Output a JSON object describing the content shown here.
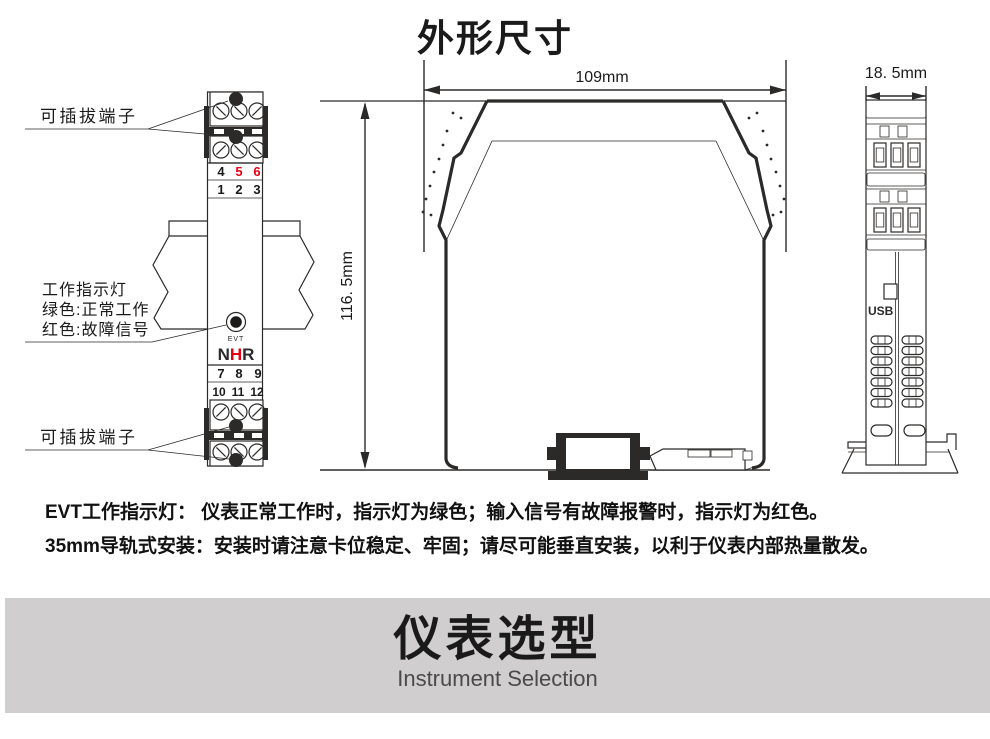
{
  "title": "外形尺寸",
  "front_view": {
    "label_pluggable_top": "可插拔端子",
    "label_pluggable_bottom": "可插拔端子",
    "indicator_label_line1": "工作指示灯",
    "indicator_label_line2": "绿色:正常工作",
    "indicator_label_line3": "红色:故障信号",
    "top_row1": [
      "4",
      "5",
      "6"
    ],
    "top_row2": [
      "1",
      "2",
      "3"
    ],
    "mid_row1": [
      "7",
      "8",
      "9"
    ],
    "mid_row2": [
      "10",
      "11",
      "12"
    ],
    "led_label": "EVT",
    "logo_n": "N",
    "logo_h": "H",
    "logo_r": "R"
  },
  "profile_view": {
    "width_dim": "109mm",
    "height_dim": "116. 5mm"
  },
  "side_view": {
    "width_dim": "18. 5mm",
    "usb_label": "USB"
  },
  "notes": [
    "EVT工作指示灯： 仪表正常工作时，指示灯为绿色；输入信号有故障报警时，指示灯为红色。",
    "35mm导轨式安装：安装时请注意卡位稳定、牢固；请尽可能垂直安装，以利于仪表内部热量散发。"
  ],
  "banner": {
    "title": "仪表选型",
    "subtitle": "Instrument Selection"
  },
  "colors": {
    "accent_red": "#e60012",
    "line": "#2b2a29",
    "banner_bg": "#d0cecf",
    "subtitle_gray": "#4a4a4a"
  }
}
